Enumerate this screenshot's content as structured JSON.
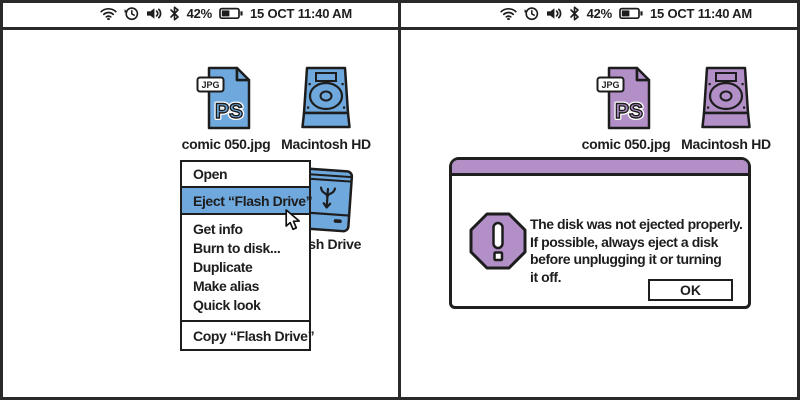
{
  "statusbar": {
    "battery_percent": "42%",
    "timestamp": "15 OCT 11:40 AM",
    "icons": [
      "wifi-icon",
      "recents-clock-icon",
      "volume-icon",
      "bluetooth-icon",
      "battery-icon"
    ]
  },
  "colors": {
    "left_accent_blue": "#6FA8DC",
    "right_accent_purple": "#B28FC6",
    "outline": "#1d1d1d",
    "background": "#ffffff"
  },
  "left_panel": {
    "desktop_icons": {
      "jpg_file": {
        "label": "comic 050.jpg",
        "badge": "JPG",
        "letters": "PS"
      },
      "hard_drive": {
        "label": "Macintosh HD"
      },
      "flash_drive": {
        "label": "Flash Drive"
      }
    },
    "context_menu": {
      "items": [
        {
          "label": "Open",
          "highlighted": false
        },
        {
          "label": "Eject “Flash Drive”",
          "highlighted": true
        },
        {
          "label": "Get info",
          "highlighted": false
        },
        {
          "label": "Burn to disk...",
          "highlighted": false
        },
        {
          "label": "Duplicate",
          "highlighted": false
        },
        {
          "label": "Make alias",
          "highlighted": false
        },
        {
          "label": "Quick look",
          "highlighted": false
        },
        {
          "label": "Copy “Flash Drive”",
          "highlighted": false
        }
      ]
    }
  },
  "right_panel": {
    "desktop_icons": {
      "jpg_file": {
        "label": "comic 050.jpg",
        "badge": "JPG",
        "letters": "PS"
      },
      "hard_drive": {
        "label": "Macintosh HD"
      }
    },
    "alert_dialog": {
      "message_lines": [
        "The disk was not ejected properly.",
        "If possible, always eject a disk",
        "before unplugging it or turning",
        "it off."
      ],
      "ok_label": "OK"
    }
  }
}
